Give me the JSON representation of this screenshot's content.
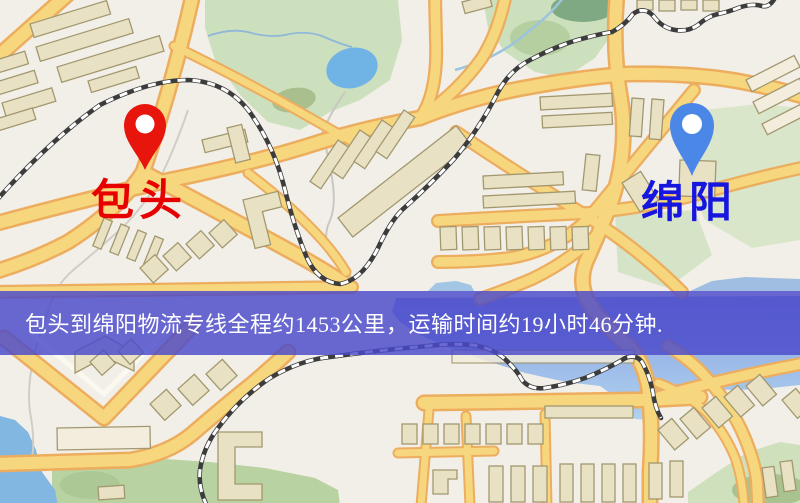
{
  "banner": {
    "text": "包头到绵阳物流专线全程约1453公里，运输时间约19小时46分钟."
  },
  "route": {
    "origin": "包头",
    "destination": "绵阳",
    "distance_text": "约1453公里",
    "duration_text": "约19小时46分钟"
  },
  "markers": {
    "origin": {
      "label": "包头"
    },
    "destination": {
      "label": "绵阳"
    }
  },
  "colors": {
    "origin_pin": "#E8150D",
    "origin_label": "#E60000",
    "destination_pin": "#4B87E6",
    "destination_label": "#1616DF",
    "banner_bg": "#4949CA",
    "banner_text": "#FFFFFF",
    "road_fill": "#F7D77E",
    "road_casing": "#EDAD5E",
    "water": "#7FB5E0",
    "park_green": "#B9D2A2"
  }
}
